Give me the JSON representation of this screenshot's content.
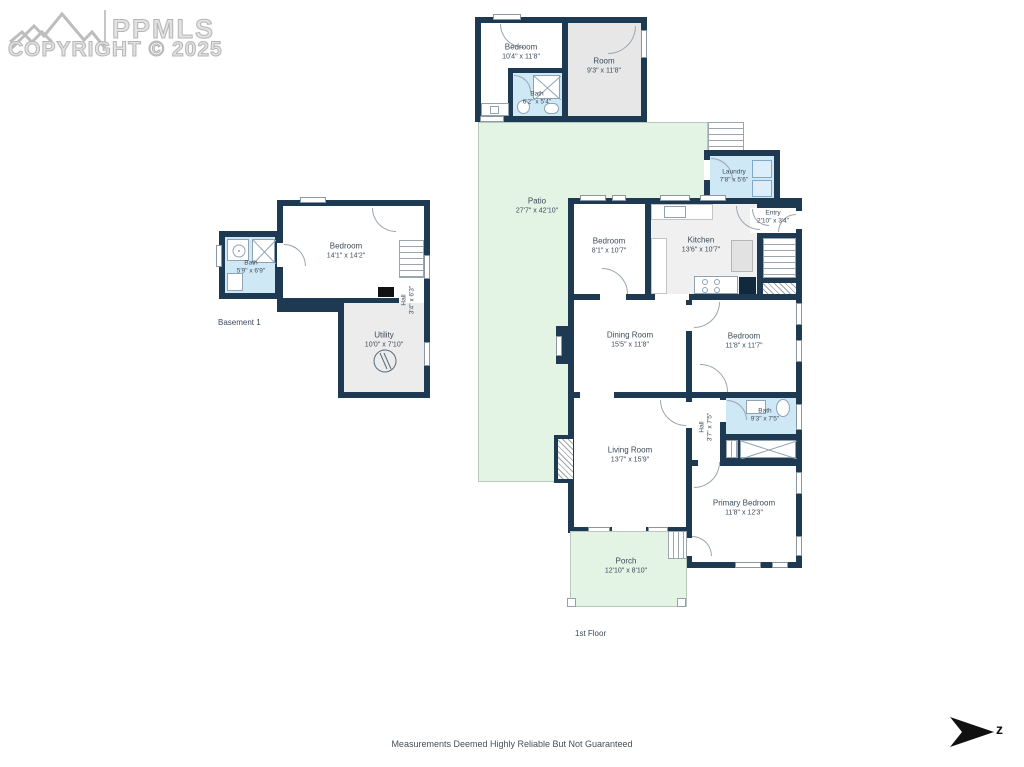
{
  "logo": {
    "brand": "PPMLS",
    "copyright": "COPYRIGHT © 2025"
  },
  "floors": {
    "basement": {
      "label": "Basement 1",
      "rooms": {
        "bedroom": {
          "name": "Bedroom",
          "dims": "14'1\" x 14'2\""
        },
        "bath": {
          "name": "Bath",
          "dims": "5'9\" x 6'9\""
        },
        "hall": {
          "name": "Hall",
          "dims": "3'4\" x 6'3\""
        },
        "utility": {
          "name": "Utility",
          "dims": "10'0\" x 7'10\""
        }
      }
    },
    "first": {
      "label": "1st Floor",
      "rooms": {
        "bedroom_top": {
          "name": "Bedroom",
          "dims": "10'4\" x 11'8\""
        },
        "room": {
          "name": "Room",
          "dims": "9'3\" x 11'8\""
        },
        "bath_top": {
          "name": "Bath",
          "dims": "6'2\" x 5'4\""
        },
        "patio": {
          "name": "Patio",
          "dims": "27'7\" x 42'10\""
        },
        "laundry": {
          "name": "Laundry",
          "dims": "7'8\" x 5'6\""
        },
        "entry": {
          "name": "Entry",
          "dims": "2'10\" x 3'4\""
        },
        "bedroom_mid": {
          "name": "Bedroom",
          "dims": "8'1\" x 10'7\""
        },
        "kitchen": {
          "name": "Kitchen",
          "dims": "13'6\" x 10'7\""
        },
        "dining": {
          "name": "Dining Room",
          "dims": "15'5\" x 11'8\""
        },
        "bedroom_right": {
          "name": "Bedroom",
          "dims": "11'8\" x 11'7\""
        },
        "living": {
          "name": "Living Room",
          "dims": "13'7\" x 15'9\""
        },
        "hall": {
          "name": "Hall",
          "dims": "3'7\" x 7'5\""
        },
        "bath": {
          "name": "Bath",
          "dims": "9'3\" x 7'5\""
        },
        "primary": {
          "name": "Primary Bedroom",
          "dims": "11'8\" x 12'3\""
        },
        "porch": {
          "name": "Porch",
          "dims": "12'10\" x 8'10\""
        }
      }
    }
  },
  "footer": {
    "disclaimer": "Measurements Deemed Highly Reliable But Not Guaranteed",
    "compass_letter": "z"
  },
  "colors": {
    "wall": "#1e3a52",
    "bath": "#cfe8f6",
    "outdoor": "#e3f3e4",
    "room_gray": "#e7e7e7"
  }
}
